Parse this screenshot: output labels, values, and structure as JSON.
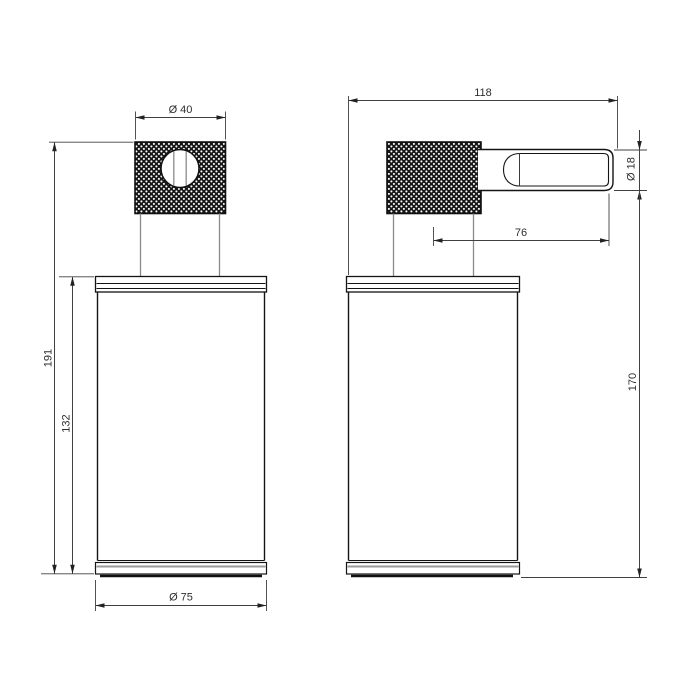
{
  "drawing": {
    "type": "technical-dimension-drawing",
    "subject": "soap-dispenser-two-view",
    "background_color": "#ffffff",
    "outline_color": "#141414",
    "dimension_color": "#404040",
    "secondary_line_color": "#8a8a8a",
    "knurl_dark_color": "#161616",
    "units": "mm",
    "labels": {
      "cap_diameter": "Ø 40",
      "overall_height": "191",
      "body_height": "132",
      "body_diameter": "Ø 75",
      "overall_width": "118",
      "spout_projection": "76",
      "spout_diameter": "Ø 18",
      "spout_height": "170"
    },
    "values": {
      "cap_diameter": 40,
      "overall_height": 191,
      "body_height": 132,
      "body_diameter": 75,
      "overall_width": 118,
      "spout_projection": 76,
      "spout_diameter": 18,
      "spout_height": 170
    }
  }
}
